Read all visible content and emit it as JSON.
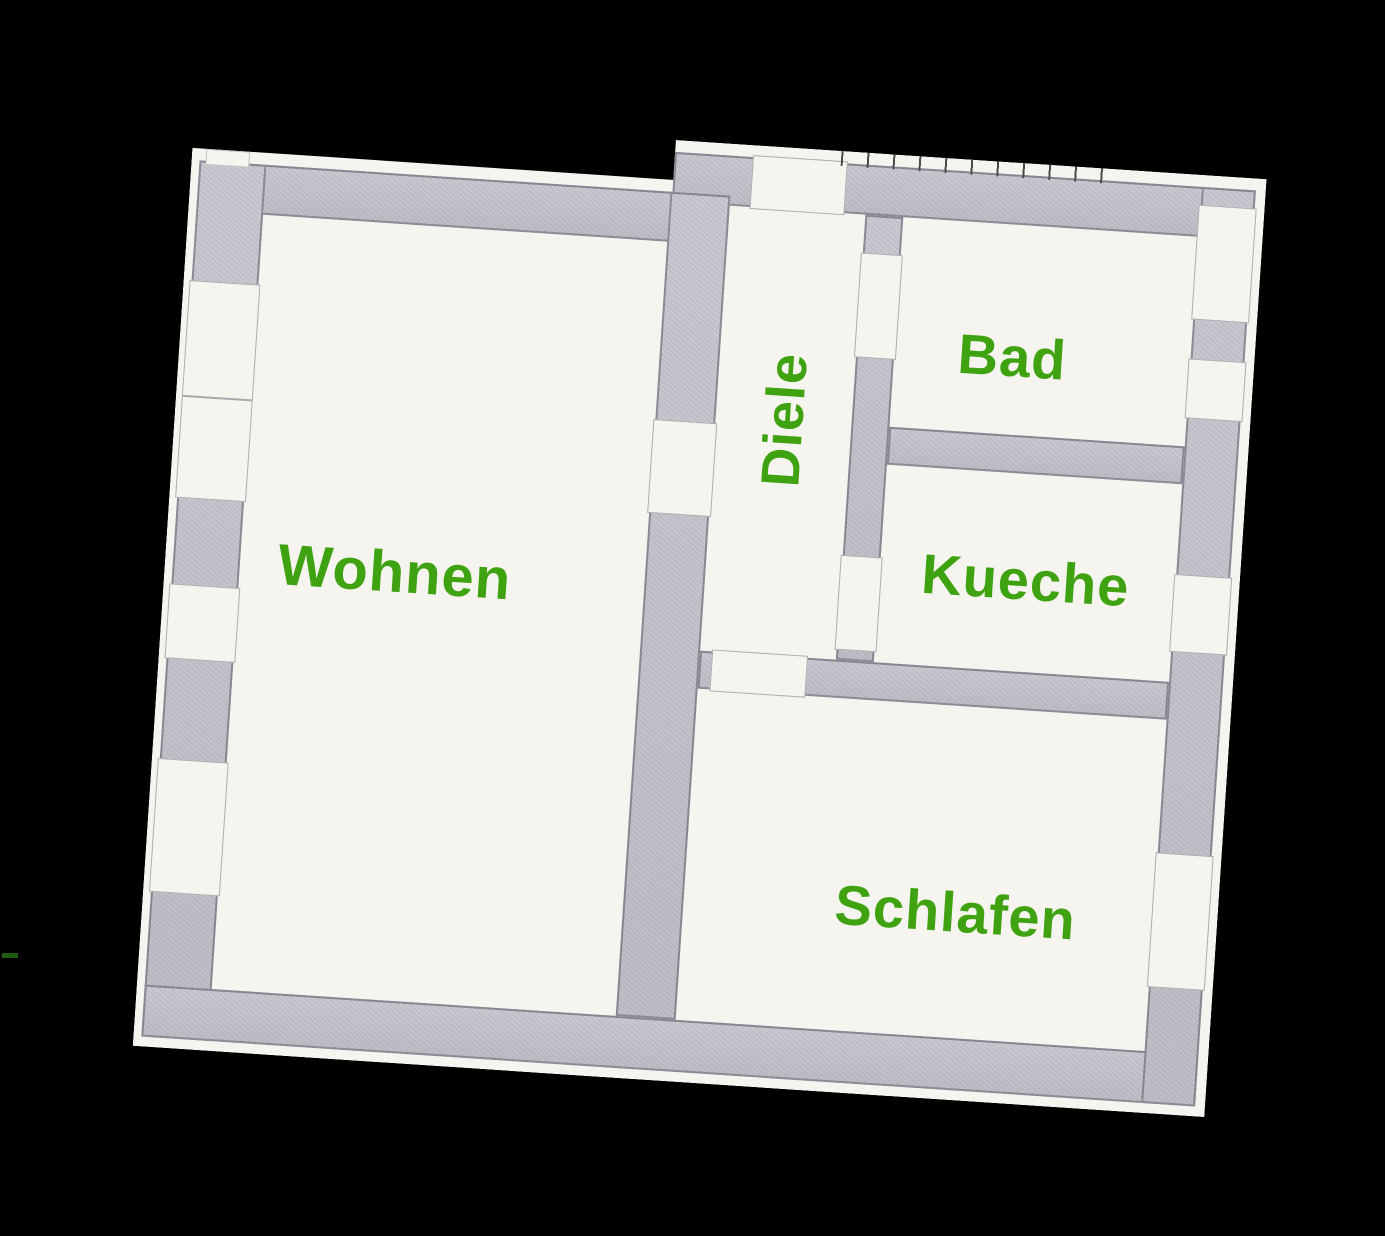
{
  "colors": {
    "background": "#000000",
    "paper": "#f5f4ee",
    "wall": "#c8c5cd",
    "label": "#3fa211"
  },
  "rooms": {
    "wohnen": {
      "label": "Wohnen"
    },
    "diele": {
      "label": "Diele"
    },
    "bad": {
      "label": "Bad"
    },
    "kueche": {
      "label": "Kueche"
    },
    "schlafen": {
      "label": "Schlafen"
    }
  }
}
